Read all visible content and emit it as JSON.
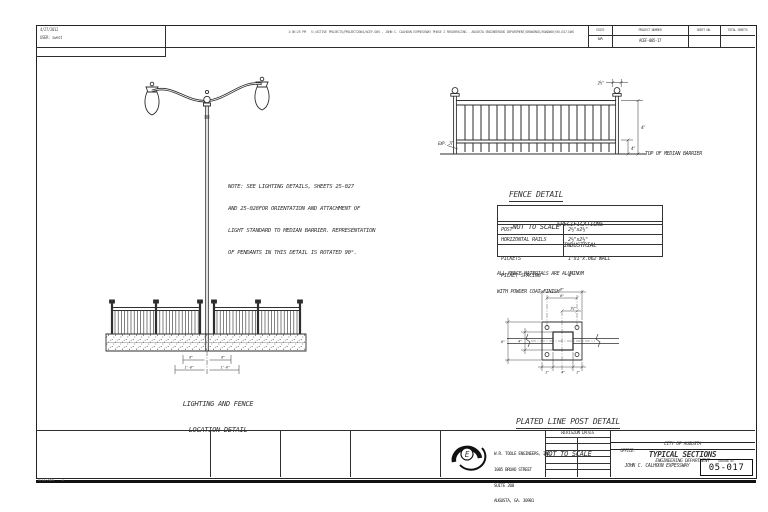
{
  "stamp": {
    "date": "4/27/2012",
    "user": "USER: swest",
    "plotinfo": "1:36:25 PM   S:/ACTIVE PROJECTS/PROJECT2004/ACEF-005 - JOHN C. CALHOUN EXPRESSWAY PHASE 2 RESURFACING - AUGUSTA ENGINEERING DEPARTMENT/DRAWINGS/ROADWAY/05-017.DWG",
    "corner": "6/14/2004    14"
  },
  "header": {
    "state_label": "STATE",
    "state_value": "GA",
    "project_label": "PROJECT NUMBER",
    "project_value": "ACEF-005-17",
    "sheet_label": "SHEET NO.",
    "total_label": "TOTAL SHEETS"
  },
  "note": {
    "line1": "NOTE: SEE LIGHTING DETAILS, SHEETS 25-027",
    "line2": "AND 25-028FOR ORIENTATION AND ATTACHMENT OF",
    "line3": "LIGHT STANDARD TO MEDIAN BARRIER. REPRESENTATION",
    "line4": "OF PENDANTS IN THIS DETAIL IS ROTATED 90°."
  },
  "lighting_detail": {
    "title_line1": "LIGHTING AND FENCE",
    "title_line2": "LOCATION DETAIL",
    "dim_left": "6\"",
    "dim_right": "6\"",
    "dim_left2": "1'-0\"",
    "dim_right2": "1'-0\""
  },
  "fence_detail": {
    "title": "FENCE DETAIL",
    "subtitle": "NOT TO SCALE",
    "barrier_label": "TOP OF MEDIAN BARRIER",
    "dim_height": "4'",
    "dim_bottom": "4\"",
    "dim_post": "2½\"",
    "leader_label": "EXP. JT."
  },
  "spec_table": {
    "title": "SPECIFICATIONS",
    "subtitle": "INDUSTRIAL",
    "rows": [
      {
        "label": "POST",
        "value": "2½\"x2½\""
      },
      {
        "label": "HORIZONTAL RAILS",
        "value": "2½\"x2½\""
      },
      {
        "label": "PICKETS",
        "label2": "PICKET SPACING",
        "value": "1\"x1\"x.062 WALL",
        "value2": "4\""
      }
    ],
    "note_line1": "ALL FENCE MATERIALS ARE ALUMINUM",
    "note_line2": "WITH POWDER COAT FINISH"
  },
  "post_detail": {
    "title": "PLATED LINE POST DETAIL",
    "subtitle": "NOT TO SCALE",
    "dim_top": "8\"",
    "dim_holes": "6\"",
    "dim_offset": "1½\"",
    "dim_side": "8\"",
    "dim_side_inner": "4\"",
    "dim_bottom": "4\"",
    "dim_corner_left": "1\"",
    "dim_corner_right": "1\""
  },
  "title_block": {
    "company_line1": "W.R. TOOLE ENGINEERS, INC.",
    "company_line2": "1005 BROAD STREET",
    "company_line3": "SUITE 200",
    "company_line4": "AUGUSTA, GA. 30901",
    "company_line5": "(706) 722-4114",
    "logo_letter": "E",
    "revision_label": "REVISION DATES",
    "dept_line1": "CITY OF AUGUSTA",
    "dept_line2": "ENGINEERING DEPARTMENT",
    "office_label": "OFFICE:",
    "sheet_title": "TYPICAL SECTIONS",
    "project_name": "JOHN C. CALHOUN EXPESSWAY",
    "drawing_no_label": "DRAWING NO.",
    "drawing_no": "05-017"
  },
  "colors": {
    "line": "#2e2e2e",
    "text": "#333333"
  }
}
